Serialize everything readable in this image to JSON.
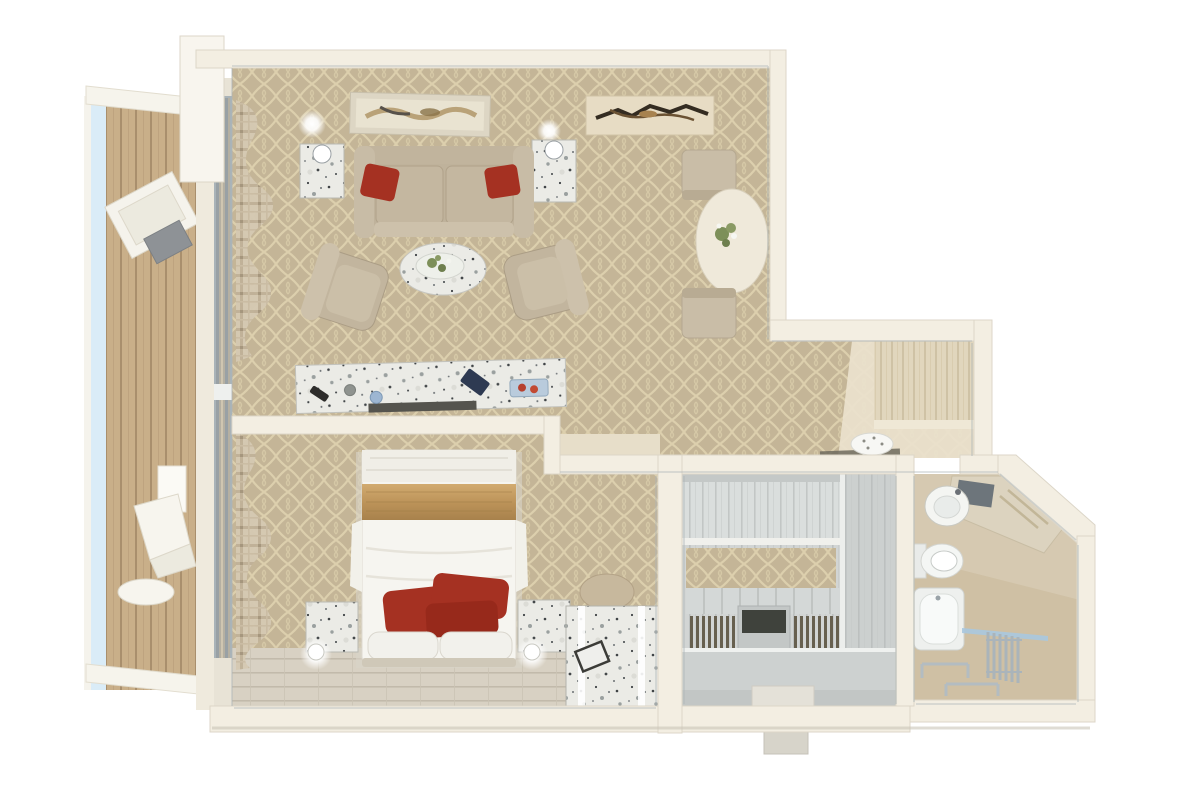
{
  "scene": {
    "title": "3D top-down floor plan rendering of a one-bedroom suite with private balcony",
    "style": "photorealistic cutaway dollhouse view, white background, no text labels"
  },
  "colors": {
    "background": "#ffffff",
    "wall": "#f3eee2",
    "wall_edge": "#d8d2c3",
    "inner_trim": "#adb5b8",
    "carpet": "#c4b597",
    "carpet_lattice": "#dccfad",
    "wood_floor": "#d8d1c3",
    "hall_vestibule": "#eae2cd",
    "closet_wood": "#d2d5d4",
    "bathroom_floor": "#cfc0a4",
    "bathroom_tile": "#d8ccb5",
    "balcony_deck": "#c9af89",
    "railing_glass": "#daecf7",
    "sofa": "#bfb29b",
    "pillow_red": "#a53122",
    "bed_white": "#f6f5f0",
    "bed_gold": "#c4a169",
    "marble_speckle_base": "#ebebe6",
    "chrome": "#aab4ba",
    "plant_green": "#7d8f59",
    "lamp_glow": "#ffffff",
    "art_dark": "#342c21"
  },
  "rooms": {
    "balcony": {
      "name": "balcony",
      "items": [
        "glass-railing",
        "teak-deck",
        "lounge-table",
        "deck-chair-upper",
        "wall-sconce",
        "deck-chair-lower",
        "leaf-side-table",
        "privacy-partition-top",
        "privacy-partition-bottom"
      ]
    },
    "living_room": {
      "name": "living-room",
      "items": [
        "abstract-art-left",
        "abstract-art-right",
        "sconce-glow-left",
        "sconce-glow-right",
        "marble-side-table-left",
        "marble-side-table-right",
        "table-lamp-left",
        "table-lamp-right",
        "sofa",
        "red-sofa-pillow-left",
        "red-sofa-pillow-right",
        "oval-marble-coffee-table",
        "plant-tray",
        "armchair-left",
        "armchair-right",
        "marble-console",
        "remote",
        "blue-glass",
        "navy-book",
        "fruit-tray",
        "dining-table",
        "flower-centerpiece",
        "dining-chair-top",
        "dining-chair-bottom",
        "plaid-curtain",
        "lattice-carpet"
      ]
    },
    "hallway": {
      "name": "entry-hall",
      "items": [
        "wood-entry-door-panel",
        "door-mat",
        "towel-sculpture",
        "vestibule-floor"
      ]
    },
    "bedroom": {
      "name": "bedroom",
      "items": [
        "double-bed",
        "gold-bed-runner",
        "red-bed-pillow-1",
        "red-bed-pillow-2",
        "red-bed-pillow-3",
        "white-pillow-left",
        "white-pillow-right",
        "nightstand-left",
        "nightstand-right",
        "bed-lamp-glow-left",
        "bed-lamp-glow-right",
        "vanity-stool",
        "marble-luggage-bench",
        "bench-straps",
        "picture-frame",
        "plaid-curtain",
        "wood-floor-strip",
        "lattice-carpet"
      ]
    },
    "walk_in_closet": {
      "name": "walk-in-closet",
      "items": [
        "upper-cabinets",
        "carpet-strip",
        "shoe-shelf-band",
        "hanger-rail-left",
        "hanger-rail-right",
        "island-dresser",
        "tall-wardrobe-unit",
        "bench-seat",
        "entry-step"
      ]
    },
    "bathroom": {
      "name": "bathroom",
      "items": [
        "corner-vanity-counter",
        "round-sink",
        "mirror",
        "toilet",
        "bathtub",
        "glass-shower-screen",
        "towel-radiator",
        "towel-rack-1",
        "towel-rack-2",
        "angled-exterior-wall"
      ]
    }
  }
}
